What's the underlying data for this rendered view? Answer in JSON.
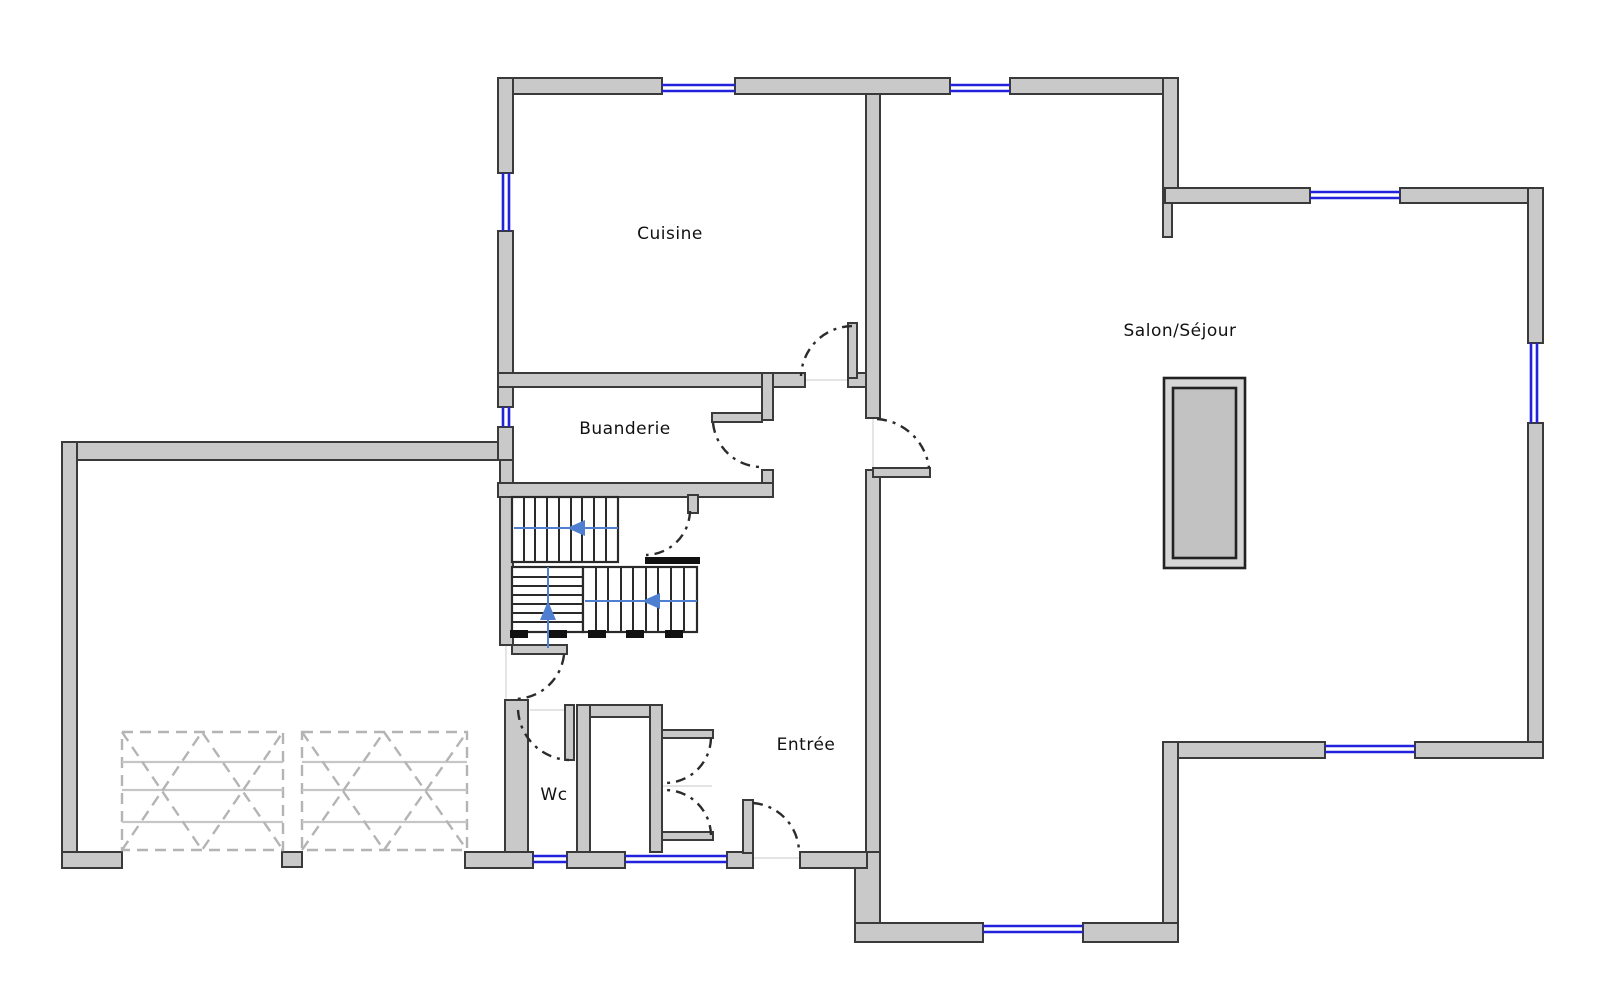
{
  "rooms": {
    "cuisine": {
      "label": "Cuisine"
    },
    "salon": {
      "label": "Salon/Séjour"
    },
    "buanderie": {
      "label": "Buanderie"
    },
    "wc": {
      "label": "Wc"
    },
    "entree": {
      "label": "Entrée"
    }
  },
  "colors": {
    "wall_fill": "#C9C9C9",
    "wall_stroke": "#3A3A3A",
    "window_blue": "#2222DD",
    "stair_blue": "#4E7FD0",
    "arc_color": "#2B2B2B",
    "tread_color": "#2A2A2A",
    "threshold_black": "#111111",
    "garage_dash": "#B4B4B4",
    "garage_line": "#C6C6C6",
    "fireplace_outer": "#D6D6D6",
    "fireplace_inner": "#C2C2C2",
    "guide": "#DCDCDC",
    "label_color": "#111111",
    "bg": "#FFFFFF"
  }
}
